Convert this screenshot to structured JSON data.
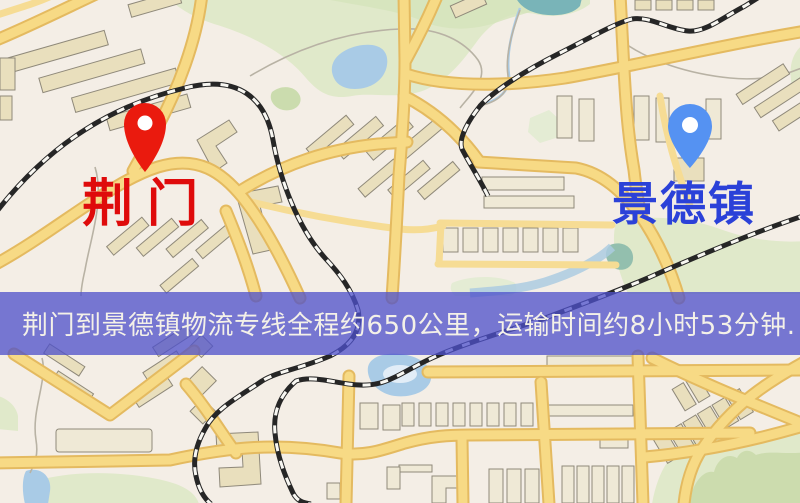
{
  "map": {
    "markers": [
      {
        "id": "origin",
        "label": "荆门",
        "pin_color": "#ea1a0e",
        "label_color": "#df0b0b"
      },
      {
        "id": "destination",
        "label": "景德镇",
        "pin_color": "#5592f2",
        "label_color": "#2b41d8"
      }
    ],
    "banner": {
      "text": "荆门到景德镇物流专线全程约650公里，运输时间约8小时53分钟.",
      "bg_color": "rgba(78,80,202,0.76)",
      "text_color": "#f4f1e8"
    },
    "colors": {
      "background": "#f4eee6",
      "road_major": "#f7da85",
      "road_casing": "#e4ba60",
      "park_green": "#e0e9ca",
      "water_blue": "#a9cbe6",
      "railway": "#262626",
      "building": "#e9dfbd"
    }
  }
}
